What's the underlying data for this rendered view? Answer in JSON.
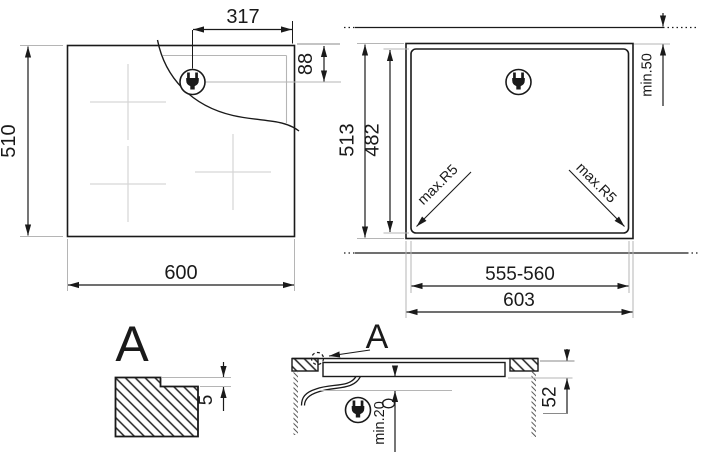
{
  "page": {
    "type": "appliance-installation-drawing",
    "background": "#ffffff",
    "line_color": "#1a1a1a",
    "secondary_line_color": "#b5b5b5",
    "zone_mark_color": "#d6d6d6"
  },
  "views": {
    "top": {
      "title": "hob-top-view",
      "width": "600",
      "height": "510",
      "plug_offset_from_right": "317",
      "plug_offset_from_top": "88",
      "icon": "power-plug-icon"
    },
    "cutout": {
      "title": "worktop-cutout-view",
      "overall_width": "603",
      "cutout_width": "555-560",
      "overall_height": "513",
      "cutout_height": "482",
      "rear_clearance": "min.50",
      "corner_radius_left": "max.R5",
      "corner_radius_right": "max.R5",
      "icon": "power-plug-icon"
    },
    "detail": {
      "label": "A",
      "recess_depth": "5"
    },
    "section": {
      "label": "A",
      "clearance_below": "min.20",
      "build_in_depth": "52",
      "icon": "power-plug-icon"
    }
  }
}
